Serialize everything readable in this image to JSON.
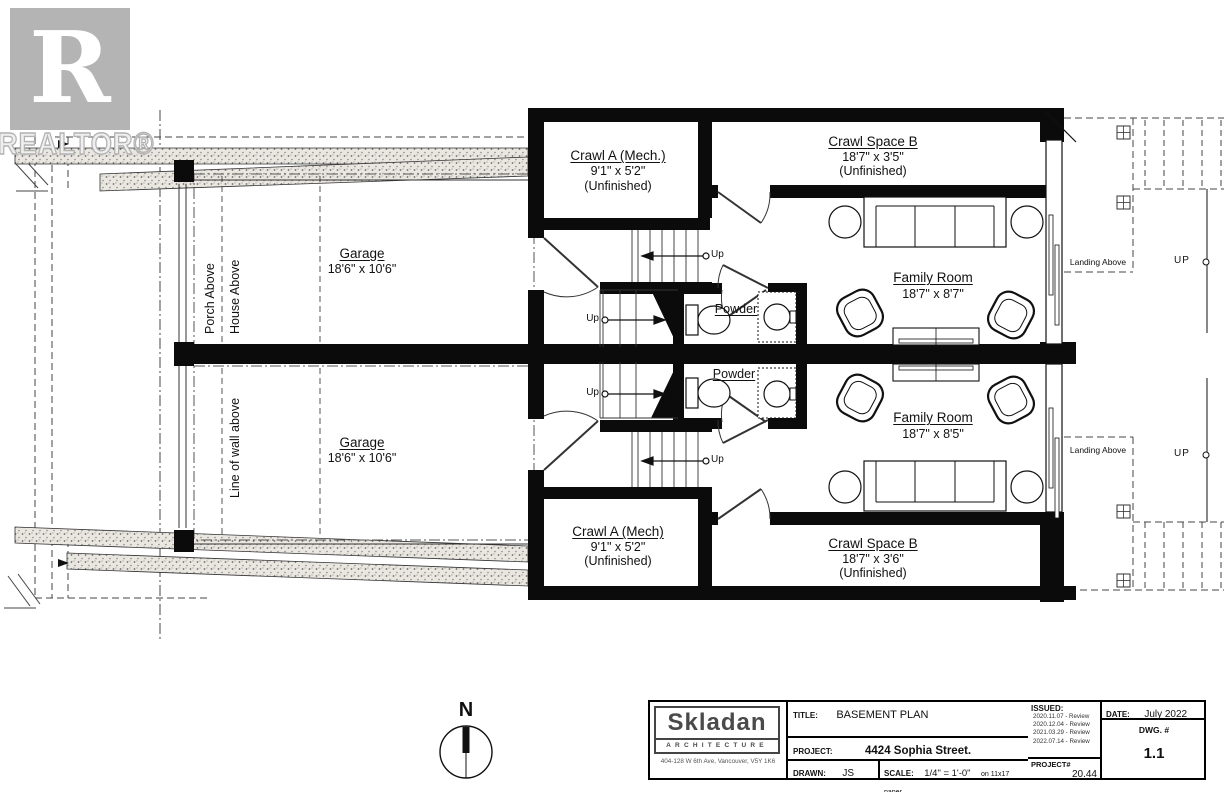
{
  "watermark": {
    "letter": "R",
    "word": "REALTOR®"
  },
  "plan": {
    "garage_top": {
      "name": "Garage",
      "dims": "18'6\" x 10'6\""
    },
    "garage_bottom": {
      "name": "Garage",
      "dims": "18'6\" x 10'6\""
    },
    "porch_above": "Porch Above",
    "house_above": "House Above",
    "line_of_wall": "Line of wall above",
    "crawl_a_top": {
      "name": "Crawl A (Mech.)",
      "dims": "9'1\" x 5'2\"",
      "status": "(Unfinished)"
    },
    "crawl_a_bottom": {
      "name": "Crawl A (Mech)",
      "dims": "9'1\" x 5'2\"",
      "status": "(Unfinished)"
    },
    "crawl_b_top": {
      "name": "Crawl Space B",
      "dims": "18'7\" x 3'5\"",
      "status": "(Unfinished)"
    },
    "crawl_b_bottom": {
      "name": "Crawl Space B",
      "dims": "18'7\" x 3'6\"",
      "status": "(Unfinished)"
    },
    "family_top": {
      "name": "Family Room",
      "dims": "18'7\" x 8'7\""
    },
    "family_bottom": {
      "name": "Family Room",
      "dims": "18'7\" x 8'5\""
    },
    "powder": "Powder",
    "up_small": "Up",
    "up_big": "UP",
    "landing": "Landing Above",
    "north": "N"
  },
  "titleblock": {
    "firm": {
      "name": "Skladan",
      "tagline": "ARCHITECTURE",
      "address": "404-128 W 6th Ave, Vancouver, V5Y 1K6"
    },
    "title_label": "TITLE:",
    "title": "BASEMENT PLAN",
    "project_label": "PROJECT:",
    "project": "4424 Sophia Street.",
    "drawn_label": "DRAWN:",
    "drawn": "JS",
    "scale_label": "SCALE:",
    "scale": "1/4\" = 1'-0\"",
    "scale_note": "on 11x17 paper",
    "issued_label": "ISSUED:",
    "issued": [
      "2020.11.07 - Review",
      "2020.12.04 - Review",
      "2021.03.29 - Review",
      "2022.07.14 - Review"
    ],
    "date_label": "DATE:",
    "date": "July 2022",
    "dwg_label": "DWG. #",
    "dwg": "1.1",
    "projnum_label": "PROJECT#",
    "projnum": "20.44"
  }
}
